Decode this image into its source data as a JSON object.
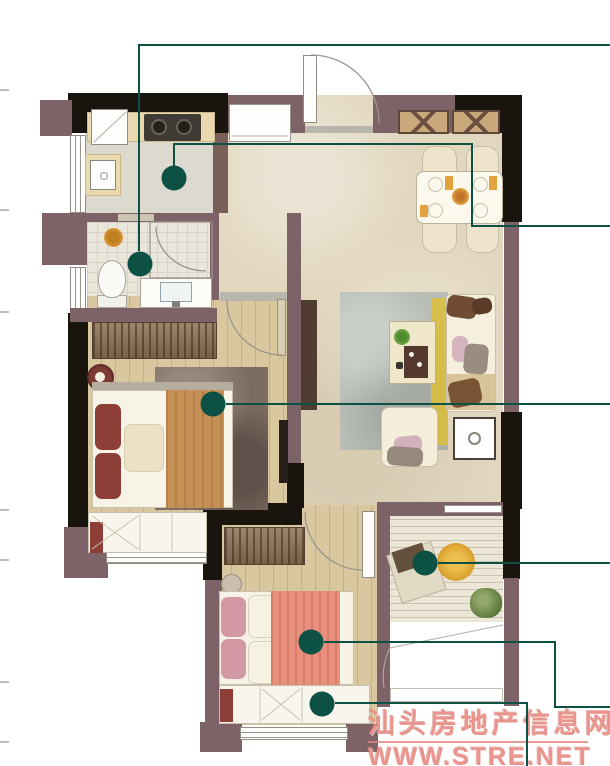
{
  "watermark": {
    "line1": "汕头房地产信息网",
    "line2": "WWW.STRE.NET"
  },
  "palette": {
    "callout_green": "#0d5044",
    "wall_maroon": "#7d6367",
    "wall_brown": "#7a5f58",
    "wall_black": "#1a140f",
    "watermark_pink": "#e9948c",
    "floor_marble": "#e1d6be",
    "floor_kitchen": "#dcdacf",
    "floor_tile": "#eae6dc",
    "floor_wood": "#d8c79f",
    "floor_deck": "#ece6d7",
    "wardrobe_brown": "#8d7457",
    "rug_gray": "#b8bdb6",
    "accent_yellow": "#dcbe3b",
    "bed_red": "#8d3e37",
    "blanket_orange": "#c59055",
    "blanket_salmon": "#e88f7e",
    "pillow_pink": "#d298a4"
  },
  "callouts": [
    {
      "id": "kitchen-marker"
    },
    {
      "id": "bathroom-marker"
    },
    {
      "id": "master-bedroom-marker"
    },
    {
      "id": "balcony-marker"
    },
    {
      "id": "second-bedroom-marker"
    },
    {
      "id": "bay-window-marker"
    }
  ]
}
